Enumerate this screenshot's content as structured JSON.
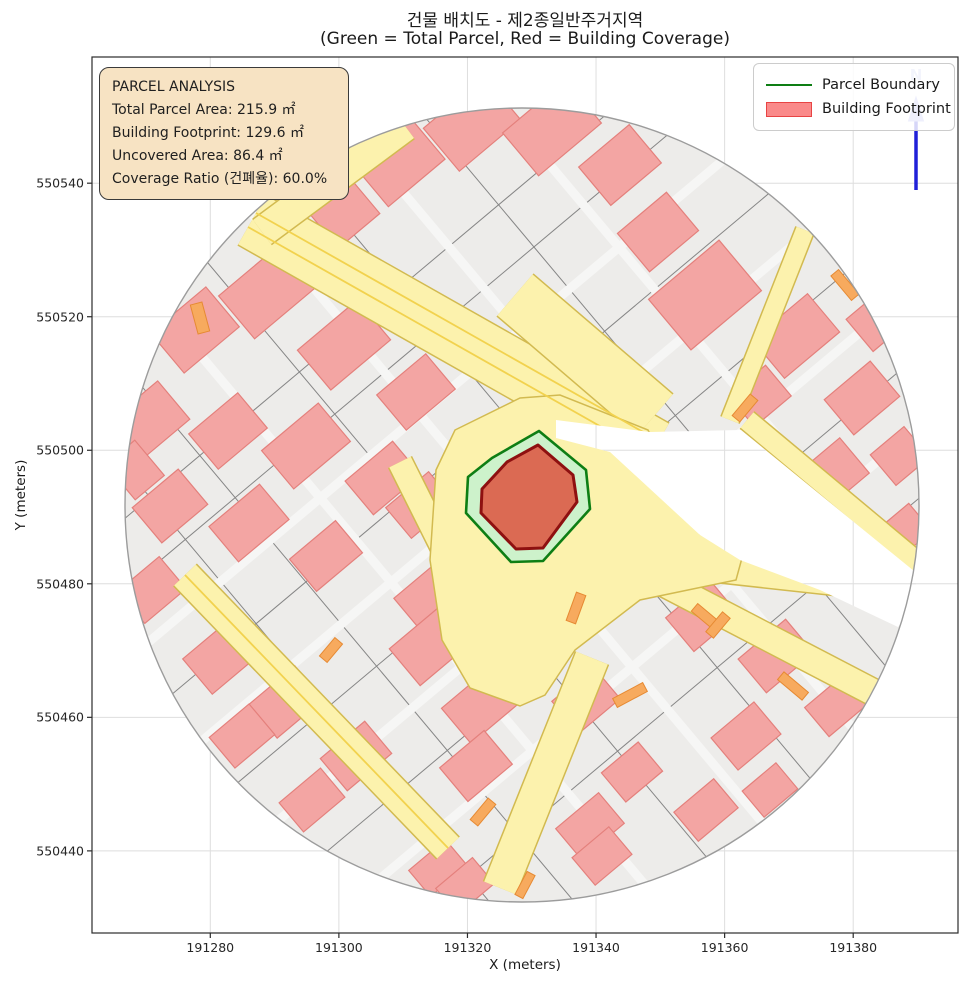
{
  "title": {
    "line1": "건물 배치도 - 제2종일반주거지역",
    "line2": "(Green = Total Parcel, Red = Building Coverage)"
  },
  "axes": {
    "x_label": "X (meters)",
    "y_label": "Y (meters)",
    "x_min": 191261.6,
    "x_max": 191396.3,
    "y_min": 550427.7,
    "y_max": 550558.9,
    "x_ticks": [
      {
        "value": 191280,
        "label": "191280"
      },
      {
        "value": 191300,
        "label": "191300"
      },
      {
        "value": 191320,
        "label": "191320"
      },
      {
        "value": 191340,
        "label": "191340"
      },
      {
        "value": 191360,
        "label": "191360"
      },
      {
        "value": 191380,
        "label": "191380"
      }
    ],
    "y_ticks": [
      {
        "value": 550440,
        "label": "550440"
      },
      {
        "value": 550460,
        "label": "550460"
      },
      {
        "value": 550480,
        "label": "550480"
      },
      {
        "value": 550500,
        "label": "550500"
      },
      {
        "value": 550520,
        "label": "550520"
      },
      {
        "value": 550540,
        "label": "550540"
      }
    ],
    "grid": true
  },
  "info_box": {
    "lines": [
      "PARCEL ANALYSIS",
      "Total Parcel Area: 215.9 ㎡",
      "Building Footprint: 129.6 ㎡",
      "Uncovered Area: 86.4 ㎡",
      "Coverage Ratio (건폐율): 60.0%"
    ]
  },
  "analysis": {
    "zone": "제2종일반주거지역",
    "total_parcel_area_m2": 215.9,
    "building_footprint_m2": 129.6,
    "uncovered_area_m2": 86.4,
    "coverage_ratio_pct": 60.0
  },
  "legend": {
    "items": [
      {
        "label": "Parcel Boundary",
        "type": "line"
      },
      {
        "label": "Building Footprint",
        "type": "patch"
      }
    ]
  },
  "north_arrow": {
    "label": "N"
  },
  "map": {
    "colors": {
      "grid": "#dedede",
      "base": "#edecea",
      "parcel_line": "#858585",
      "corridor": "#f6f6f5",
      "building_fill": "#f3a5a3",
      "building_stroke": "#e4807c",
      "road_fill": "#fcf2ad",
      "road_edge": "#d2ba50",
      "road_center": "#f2d24e",
      "orange_fill": "#f7aa5e",
      "orange_stroke": "#e68a33",
      "rim": "#9c9c9c",
      "wedge": "#ffffff",
      "hl_parcel_fill": "#cdf2cb",
      "hl_parcel_stroke": "#0e7e14",
      "hl_building_fill": "#db6a53",
      "hl_building_stroke": "#8e1010",
      "spine": "#2b2b2b",
      "north_line": "#2020d8",
      "north_head": "#9fa8ec"
    },
    "plot_box": {
      "x": 92,
      "y": 57,
      "w": 866,
      "h": 876
    },
    "circle": {
      "cx": 522,
      "cy": 505,
      "r": 397
    },
    "lattice": {
      "angle_deg": 40,
      "a_offsets": [
        -245,
        -190,
        -135,
        -80,
        -25,
        30,
        85,
        140,
        195,
        250
      ],
      "b_offsets": [
        -280,
        -215,
        -150,
        -85,
        -20,
        45,
        110,
        175,
        240
      ],
      "corridor_a": [
        -135,
        -25,
        85,
        195
      ],
      "corridor_b": [
        -150,
        -20,
        110,
        240
      ]
    },
    "buildings": [
      [
        400,
        163,
        74,
        52
      ],
      [
        472,
        124,
        80,
        56
      ],
      [
        552,
        128,
        82,
        56
      ],
      [
        620,
        165,
        66,
        50
      ],
      [
        658,
        232,
        64,
        50
      ],
      [
        705,
        295,
        92,
        66
      ],
      [
        345,
        214,
        54,
        44
      ],
      [
        195,
        330,
        72,
        52
      ],
      [
        268,
        291,
        82,
        56
      ],
      [
        344,
        345,
        78,
        52
      ],
      [
        416,
        392,
        64,
        46
      ],
      [
        150,
        420,
        62,
        50
      ],
      [
        228,
        431,
        64,
        46
      ],
      [
        306,
        446,
        74,
        50
      ],
      [
        383,
        478,
        62,
        44
      ],
      [
        170,
        506,
        60,
        46
      ],
      [
        249,
        523,
        66,
        46
      ],
      [
        326,
        556,
        60,
        42
      ],
      [
        420,
        505,
        56,
        40
      ],
      [
        437,
        600,
        64,
        58
      ],
      [
        135,
        470,
        38,
        46
      ],
      [
        152,
        590,
        54,
        42
      ],
      [
        222,
        656,
        64,
        46
      ],
      [
        286,
        702,
        60,
        44
      ],
      [
        356,
        756,
        58,
        42
      ],
      [
        242,
        736,
        52,
        40
      ],
      [
        312,
        800,
        54,
        38
      ],
      [
        438,
        868,
        48,
        34
      ],
      [
        430,
        646,
        66,
        48
      ],
      [
        480,
        706,
        62,
        46
      ],
      [
        476,
        766,
        58,
        44
      ],
      [
        590,
        826,
        56,
        40
      ],
      [
        586,
        700,
        54,
        42
      ],
      [
        632,
        772,
        48,
        38
      ],
      [
        465,
        886,
        48,
        34
      ],
      [
        602,
        856,
        48,
        36
      ],
      [
        702,
        616,
        58,
        44
      ],
      [
        776,
        656,
        62,
        44
      ],
      [
        746,
        736,
        56,
        42
      ],
      [
        836,
        706,
        50,
        38
      ],
      [
        706,
        810,
        52,
        38
      ],
      [
        770,
        790,
        44,
        34
      ],
      [
        796,
        336,
        72,
        50
      ],
      [
        862,
        398,
        60,
        46
      ],
      [
        830,
        476,
        64,
        46
      ],
      [
        900,
        456,
        44,
        40
      ],
      [
        760,
        396,
        48,
        40
      ],
      [
        878,
        320,
        48,
        42
      ],
      [
        905,
        530,
        40,
        36
      ]
    ],
    "building_angle": -40,
    "roads": [
      {
        "pts": [
          [
            252,
            220
          ],
          [
            655,
            448
          ]
        ],
        "w": 56
      },
      {
        "pts": [
          [
            515,
            295
          ],
          [
            655,
            415
          ]
        ],
        "w": 54
      },
      {
        "pts": [
          [
            262,
            232
          ],
          [
            405,
            126
          ]
        ],
        "w": 30
      },
      {
        "pts": [
          [
            747,
            420
          ],
          [
            922,
            566
          ]
        ],
        "w": 20
      },
      {
        "pts": [
          [
            400,
            462
          ],
          [
            478,
            618
          ]
        ],
        "w": 24
      },
      {
        "pts": [
          [
            590,
            556
          ],
          [
            918,
            592
          ]
        ],
        "w": 24
      },
      {
        "pts": [
          [
            650,
            576
          ],
          [
            892,
            702
          ]
        ],
        "w": 26
      },
      {
        "pts": [
          [
            185,
            575
          ],
          [
            448,
            848
          ]
        ],
        "w": 30
      },
      {
        "pts": [
          [
            730,
            420
          ],
          [
            805,
            230
          ]
        ],
        "w": 18
      },
      {
        "pts": [
          [
            592,
            658
          ],
          [
            500,
            888
          ]
        ],
        "w": 34
      }
    ],
    "road_centerlines": [
      [
        [
          248,
          227
        ],
        [
          651,
          455
        ]
      ],
      [
        [
          256,
          213
        ],
        [
          659,
          441
        ]
      ],
      [
        [
          185,
          575
        ],
        [
          448,
          848
        ]
      ]
    ],
    "junction": [
      [
        430,
        560
      ],
      [
        436,
        470
      ],
      [
        455,
        430
      ],
      [
        520,
        398
      ],
      [
        560,
        395
      ],
      [
        648,
        430
      ],
      [
        700,
        534
      ],
      [
        742,
        558
      ],
      [
        736,
        580
      ],
      [
        640,
        600
      ],
      [
        575,
        650
      ],
      [
        545,
        695
      ],
      [
        520,
        706
      ],
      [
        470,
        688
      ],
      [
        442,
        640
      ]
    ],
    "wedge": [
      [
        556,
        420
      ],
      [
        650,
        432
      ],
      [
        741,
        430
      ],
      [
        914,
        571
      ],
      [
        919,
        600
      ],
      [
        898,
        627
      ],
      [
        820,
        590
      ],
      [
        740,
        560
      ],
      [
        700,
        535
      ],
      [
        610,
        452
      ],
      [
        556,
        438
      ]
    ],
    "oranges": [
      [
        200,
        318,
        12,
        30,
        -15
      ],
      [
        845,
        285,
        32,
        10,
        50
      ],
      [
        745,
        408,
        10,
        28,
        40
      ],
      [
        576,
        608,
        10,
        30,
        20
      ],
      [
        706,
        617,
        30,
        10,
        40
      ],
      [
        793,
        686,
        32,
        10,
        40
      ],
      [
        483,
        812,
        10,
        28,
        40
      ],
      [
        630,
        695,
        34,
        10,
        -28
      ],
      [
        331,
        650,
        10,
        24,
        40
      ],
      [
        525,
        885,
        26,
        9,
        -62
      ],
      [
        718,
        625,
        10,
        26,
        40
      ]
    ],
    "parcel_polygon": [
      [
        539,
        431
      ],
      [
        586,
        470
      ],
      [
        590,
        509
      ],
      [
        543,
        561
      ],
      [
        511,
        562
      ],
      [
        466,
        513
      ],
      [
        468,
        477
      ],
      [
        492,
        458
      ]
    ],
    "building_polygon": [
      [
        538,
        445
      ],
      [
        573,
        475
      ],
      [
        577,
        502
      ],
      [
        543,
        548
      ],
      [
        516,
        549
      ],
      [
        481,
        513
      ],
      [
        482,
        489
      ],
      [
        507,
        462
      ]
    ],
    "north": {
      "x": 916,
      "y_top": 116,
      "y_bottom": 190,
      "head": [
        [
          916,
          97
        ],
        [
          908.5,
          121
        ],
        [
          923.5,
          121
        ]
      ]
    }
  }
}
